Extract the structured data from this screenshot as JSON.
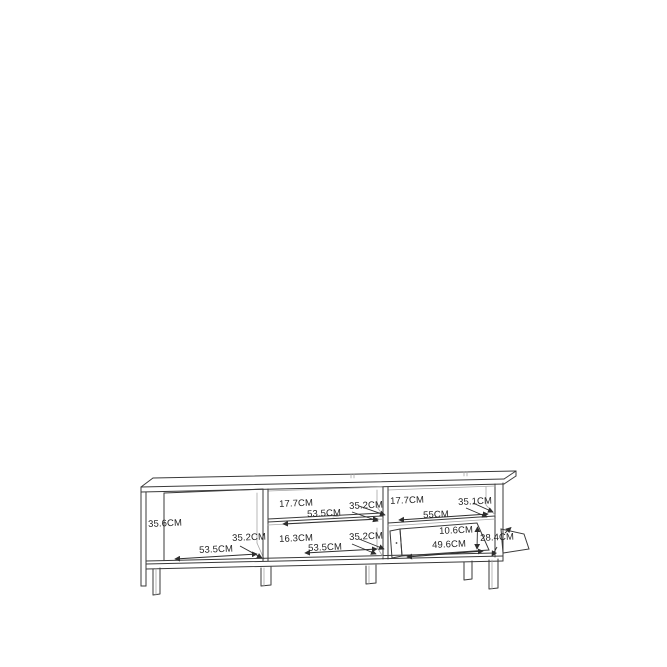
{
  "page": {
    "background_color": "#ffffff",
    "line_color": "#3a3a3a",
    "light_line_color": "#a6a6a6",
    "text_color": "#1f1f1f"
  },
  "diagram": {
    "kind": "furniture-dimension-drawing",
    "subject": "TV cabinet with open compartments and fold-down flap",
    "unit": "CM",
    "sections": [
      {
        "name": "left-compartment",
        "height": "35.6CM",
        "width": "53.5CM",
        "depth": "35.2CM"
      },
      {
        "name": "middle-top-compartment",
        "height": "17.7CM",
        "width": "53.5CM",
        "depth": "35.2CM"
      },
      {
        "name": "middle-bottom-compartment",
        "height": "16.3CM",
        "width": "53.5CM",
        "depth": "35.2CM"
      },
      {
        "name": "right-top-compartment",
        "height": "17.7CM",
        "width": "55CM",
        "depth": "35.1CM"
      },
      {
        "name": "right-flap-drawer",
        "height": "10.6CM",
        "width": "49.6CM",
        "depth": "28.4CM"
      }
    ]
  }
}
